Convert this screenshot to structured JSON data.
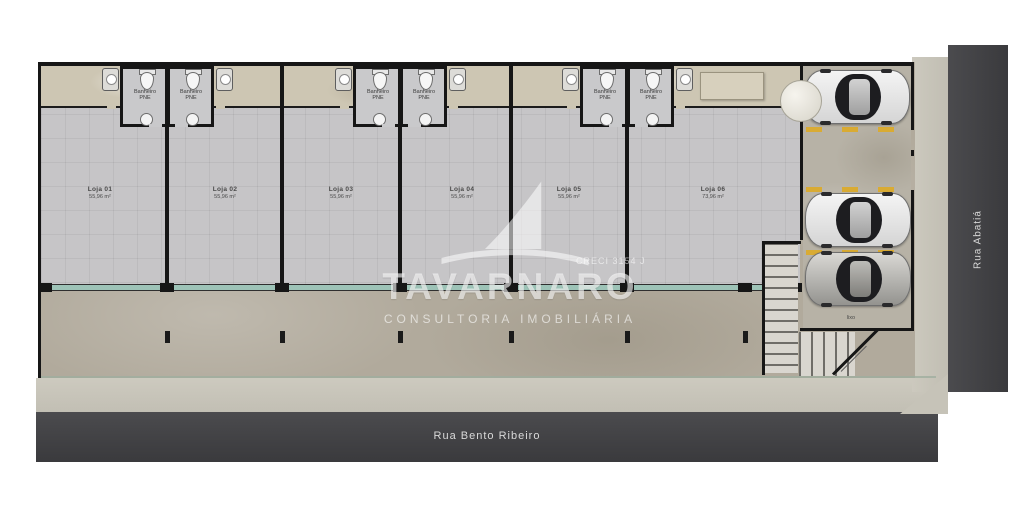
{
  "plan": {
    "streets": {
      "bottom": "Rua Bento Ribeiro",
      "right": "Rua Abatiá"
    },
    "watermark": {
      "brand": "TAVARNARO",
      "subtitle": "CONSULTORIA  IMOBILIÁRIA",
      "creci": "CRECI 3154 J"
    },
    "units": [
      {
        "name": "Loja 01",
        "area": "55,96 m²"
      },
      {
        "name": "Loja 02",
        "area": "55,96 m²"
      },
      {
        "name": "Loja 03",
        "area": "55,96 m²"
      },
      {
        "name": "Loja 04",
        "area": "55,96 m²"
      },
      {
        "name": "Loja 05",
        "area": "55,96 m²"
      },
      {
        "name": "Loja 06",
        "area": "73,96 m²"
      }
    ],
    "bathroom": {
      "line1": "Banheiro",
      "line2": "PNE"
    },
    "utility_label": "lixo",
    "colors": {
      "road": "#434346",
      "sidewalk": "#c9c6bc",
      "shop_floor": "#c6c5c7",
      "plot": "#b1aa9c",
      "parking_dash": "#d9ab33",
      "storefront_glass": "#9dc3b7",
      "wall": "#161616"
    }
  }
}
